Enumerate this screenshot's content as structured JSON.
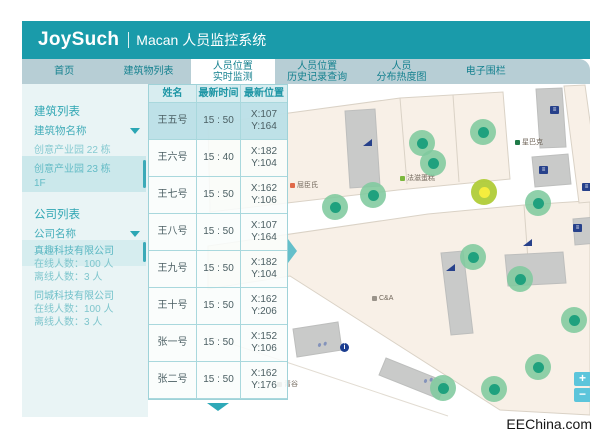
{
  "header": {
    "brand": "JoySuch",
    "subtitle": "Macan 人员监控系统"
  },
  "tabs": [
    {
      "id": "home",
      "line1": "首页",
      "active": false
    },
    {
      "id": "building-list",
      "line1": "建筑物列表",
      "active": false
    },
    {
      "id": "realtime-monitor",
      "line1": "人员位置",
      "line2": "实时监测",
      "active": true
    },
    {
      "id": "history-query",
      "line1": "人员位置",
      "line2": "历史记录查询",
      "active": false
    },
    {
      "id": "heatmap",
      "line1": "人员",
      "line2": "分布热度图",
      "active": false
    },
    {
      "id": "e-fence",
      "line1": "电子围栏",
      "active": false
    }
  ],
  "sidebar": {
    "building": {
      "title": "建筑列表",
      "filter": "建筑物名称",
      "items": [
        {
          "name": "创意产业园 22 栋",
          "selected": false
        },
        {
          "name": "创意产业园 23 栋",
          "floor": "1F",
          "selected": true
        }
      ]
    },
    "company": {
      "title": "公司列表",
      "filter": "公司名称",
      "items": [
        {
          "name": "真趣科技有限公司",
          "online": "在线人数：100 人",
          "offline": "离线人数：3 人",
          "selected": true
        },
        {
          "name": "同城科技有限公司",
          "online": "在线人数：100 人",
          "offline": "离线人数：3 人",
          "selected": false
        }
      ]
    }
  },
  "table": {
    "columns": [
      "姓名",
      "最新时间",
      "最新位置"
    ],
    "rows": [
      {
        "name": "王五号",
        "time": "15 : 50",
        "pos": {
          "x": "X:107",
          "y": "Y:164"
        },
        "selected": true
      },
      {
        "name": "王六号",
        "time": "15 : 40",
        "pos": {
          "x": "X:182",
          "y": "Y:104"
        },
        "selected": false
      },
      {
        "name": "王七号",
        "time": "15 : 50",
        "pos": {
          "x": "X:162",
          "y": "Y:106"
        },
        "selected": false
      },
      {
        "name": "王八号",
        "time": "15 : 50",
        "pos": {
          "x": "X:107",
          "y": "Y:164"
        },
        "selected": false
      },
      {
        "name": "王九号",
        "time": "15 : 50",
        "pos": {
          "x": "X:182",
          "y": "Y:104"
        },
        "selected": false
      },
      {
        "name": "王十号",
        "time": "15 : 50",
        "pos": {
          "x": "X:162",
          "y": "Y:206"
        },
        "selected": false
      },
      {
        "name": "张一号",
        "time": "15 : 50",
        "pos": {
          "x": "X:152",
          "y": "Y:106"
        },
        "selected": false
      },
      {
        "name": "张二号",
        "time": "15 : 50",
        "pos": {
          "x": "X:162",
          "y": "Y:176"
        },
        "selected": false
      }
    ]
  },
  "map": {
    "stores": [
      {
        "id": "watsons",
        "label": "屈臣氏",
        "icon_color": "#E06A4A",
        "x": 142,
        "y": 96
      },
      {
        "id": "fazi-bakery",
        "label": "法滋蛋糕",
        "icon_color": "#7CB83E",
        "x": 252,
        "y": 89
      },
      {
        "id": "starbucks",
        "label": "星巴克",
        "icon_color": "#1F7A47",
        "x": 367,
        "y": 53
      },
      {
        "id": "c-and-a",
        "label": "C&A",
        "icon_color": "#9A938A",
        "x": 224,
        "y": 211
      },
      {
        "id": "qinggu",
        "label": "青谷",
        "icon_color": "#9A938A",
        "x": 129,
        "y": 295
      }
    ],
    "markers": [
      {
        "x": 274,
        "y": 59,
        "selected": false
      },
      {
        "x": 285,
        "y": 79,
        "selected": false
      },
      {
        "x": 335,
        "y": 48,
        "selected": false
      },
      {
        "x": 225,
        "y": 111,
        "selected": false
      },
      {
        "x": 187,
        "y": 123,
        "selected": false
      },
      {
        "x": 390,
        "y": 119,
        "selected": false
      },
      {
        "x": 336,
        "y": 108,
        "selected": true
      },
      {
        "x": 325,
        "y": 173,
        "selected": false
      },
      {
        "x": 372,
        "y": 195,
        "selected": false
      },
      {
        "x": 426,
        "y": 236,
        "selected": false
      },
      {
        "x": 390,
        "y": 283,
        "selected": false
      },
      {
        "x": 346,
        "y": 305,
        "selected": false
      },
      {
        "x": 295,
        "y": 304,
        "selected": false
      }
    ],
    "controls": {
      "zoom_in": "+",
      "zoom_out": "−"
    }
  },
  "watermark": "EEChina.com",
  "colors": {
    "header_teal": "#1A9BAA",
    "tabbar": "#B7CED5",
    "sidebar_bg": "#E9F4F5",
    "selected_row": "#BBE0E7",
    "marker_green": "#1FA17E",
    "marker_selected": "#F5ED3E",
    "map_floor": "#F8F0E7",
    "map_gray": "#C9CAC9"
  }
}
